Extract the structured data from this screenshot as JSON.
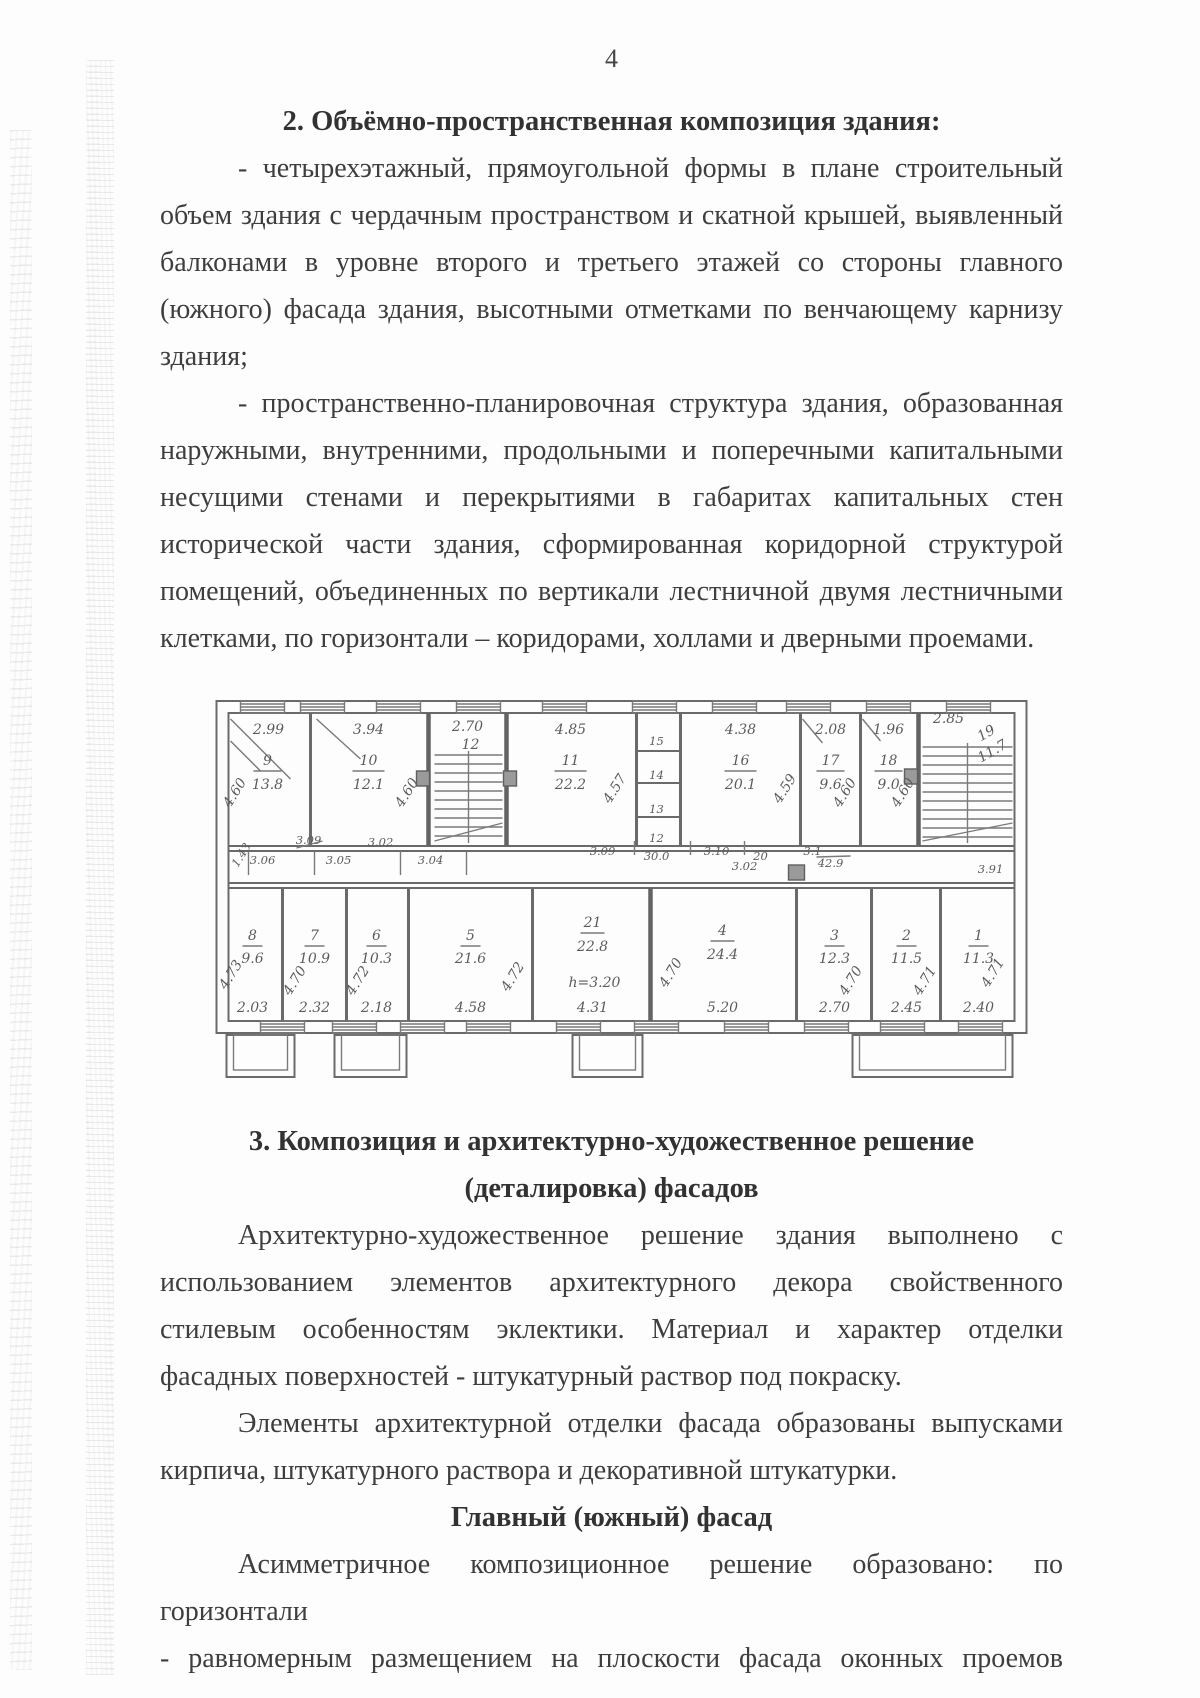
{
  "page": {
    "number": "4"
  },
  "section2": {
    "heading": "2. Объёмно-пространственная композиция здания:",
    "para1": "- четырехэтажный, прямоугольной формы в плане строительный объем здания с чердачным пространством и скатной крышей, выявленный балконами в уровне второго и третьего этажей со стороны главного (южного) фасада здания, высотными отметками по венчающему карнизу здания;",
    "para2": "- пространственно-планировочная структура здания, образованная наружными, внутренними, продольными и поперечными капитальными несущими стенами и перекрытиями в габаритах капитальных стен исторической части здания, сформированная коридорной структурой помещений, объединенных по вертикали лестничной двумя лестничными клетками, по горизонтали – коридорами, холлами и дверными проемами."
  },
  "plan": {
    "top": [
      {
        "n": "9",
        "a": "13.8",
        "w": "2.99",
        "d": "4.60"
      },
      {
        "n": "10",
        "a": "12.1",
        "w": "3.94",
        "d": "4.60"
      },
      {
        "n": "11",
        "a": "22.2",
        "w": "4.85",
        "d": "4.57"
      },
      {
        "n": "16",
        "a": "20.1",
        "w": "4.38",
        "d": "4.59"
      },
      {
        "n": "17",
        "a": "9.6",
        "w": "2.08",
        "d": "4.60"
      },
      {
        "n": "18",
        "a": "9.0",
        "w": "1.96",
        "d": "4.60"
      }
    ],
    "stair_left": {
      "w": "2.70",
      "n": "12"
    },
    "stack": [
      "15",
      "14",
      "13",
      "12"
    ],
    "stair_right": {
      "w": "2.85",
      "n": "19",
      "a": "11.7"
    },
    "bot": [
      {
        "n": "8",
        "a": "9.6",
        "w": "2.03",
        "d": "4.73"
      },
      {
        "n": "7",
        "a": "10.9",
        "w": "2.32",
        "d": "4.70"
      },
      {
        "n": "6",
        "a": "10.3",
        "w": "2.18",
        "d": "4.72"
      },
      {
        "n": "5",
        "a": "21.6",
        "w": "4.58",
        "d": "4.72"
      },
      {
        "n": "21",
        "a": "22.8",
        "w": "4.31",
        "h": "h=3.20",
        "d": "4.70"
      },
      {
        "n": "4",
        "a": "24.4",
        "w": "5.20"
      },
      {
        "n": "3",
        "a": "12.3",
        "w": "2.70",
        "d": "4.70"
      },
      {
        "n": "2",
        "a": "11.5",
        "w": "2.45",
        "d": "4.71"
      },
      {
        "n": "1",
        "a": "11.3",
        "w": "2.40",
        "d": "4.71"
      }
    ],
    "wd": {
      "diag": "1.43",
      "a": "3.09",
      "b": "3.02",
      "c": "3.09",
      "d": "30.0",
      "e": "3.10",
      "f": "20",
      "g": "3.1",
      "r": "3.91"
    },
    "cd": {
      "a": "3.06",
      "b": "3.05",
      "c": "3.04",
      "d": "3.02",
      "e": "42.9"
    }
  },
  "section3": {
    "heading_line1": "3. Композиция и архитектурно-художественное решение",
    "heading_line2": "(деталировка) фасадов",
    "para1": "Архитектурно-художественное решение здания выполнено с использованием элементов архитектурного декора свойственного стилевым особенностям эклектики. Материал и характер отделки фасадных поверхностей - штукатурный раствор под покраску.",
    "para2": "Элементы архитектурной отделки фасада образованы выпусками кирпича, штукатурного раствора и декоративной штукатурки.",
    "subheading": "Главный (южный) фасад",
    "para3": "Асимметричное композиционное решение образовано: по горизонтали",
    "para4": "- равномерным размещением на плоскости фасада оконных проемов"
  }
}
